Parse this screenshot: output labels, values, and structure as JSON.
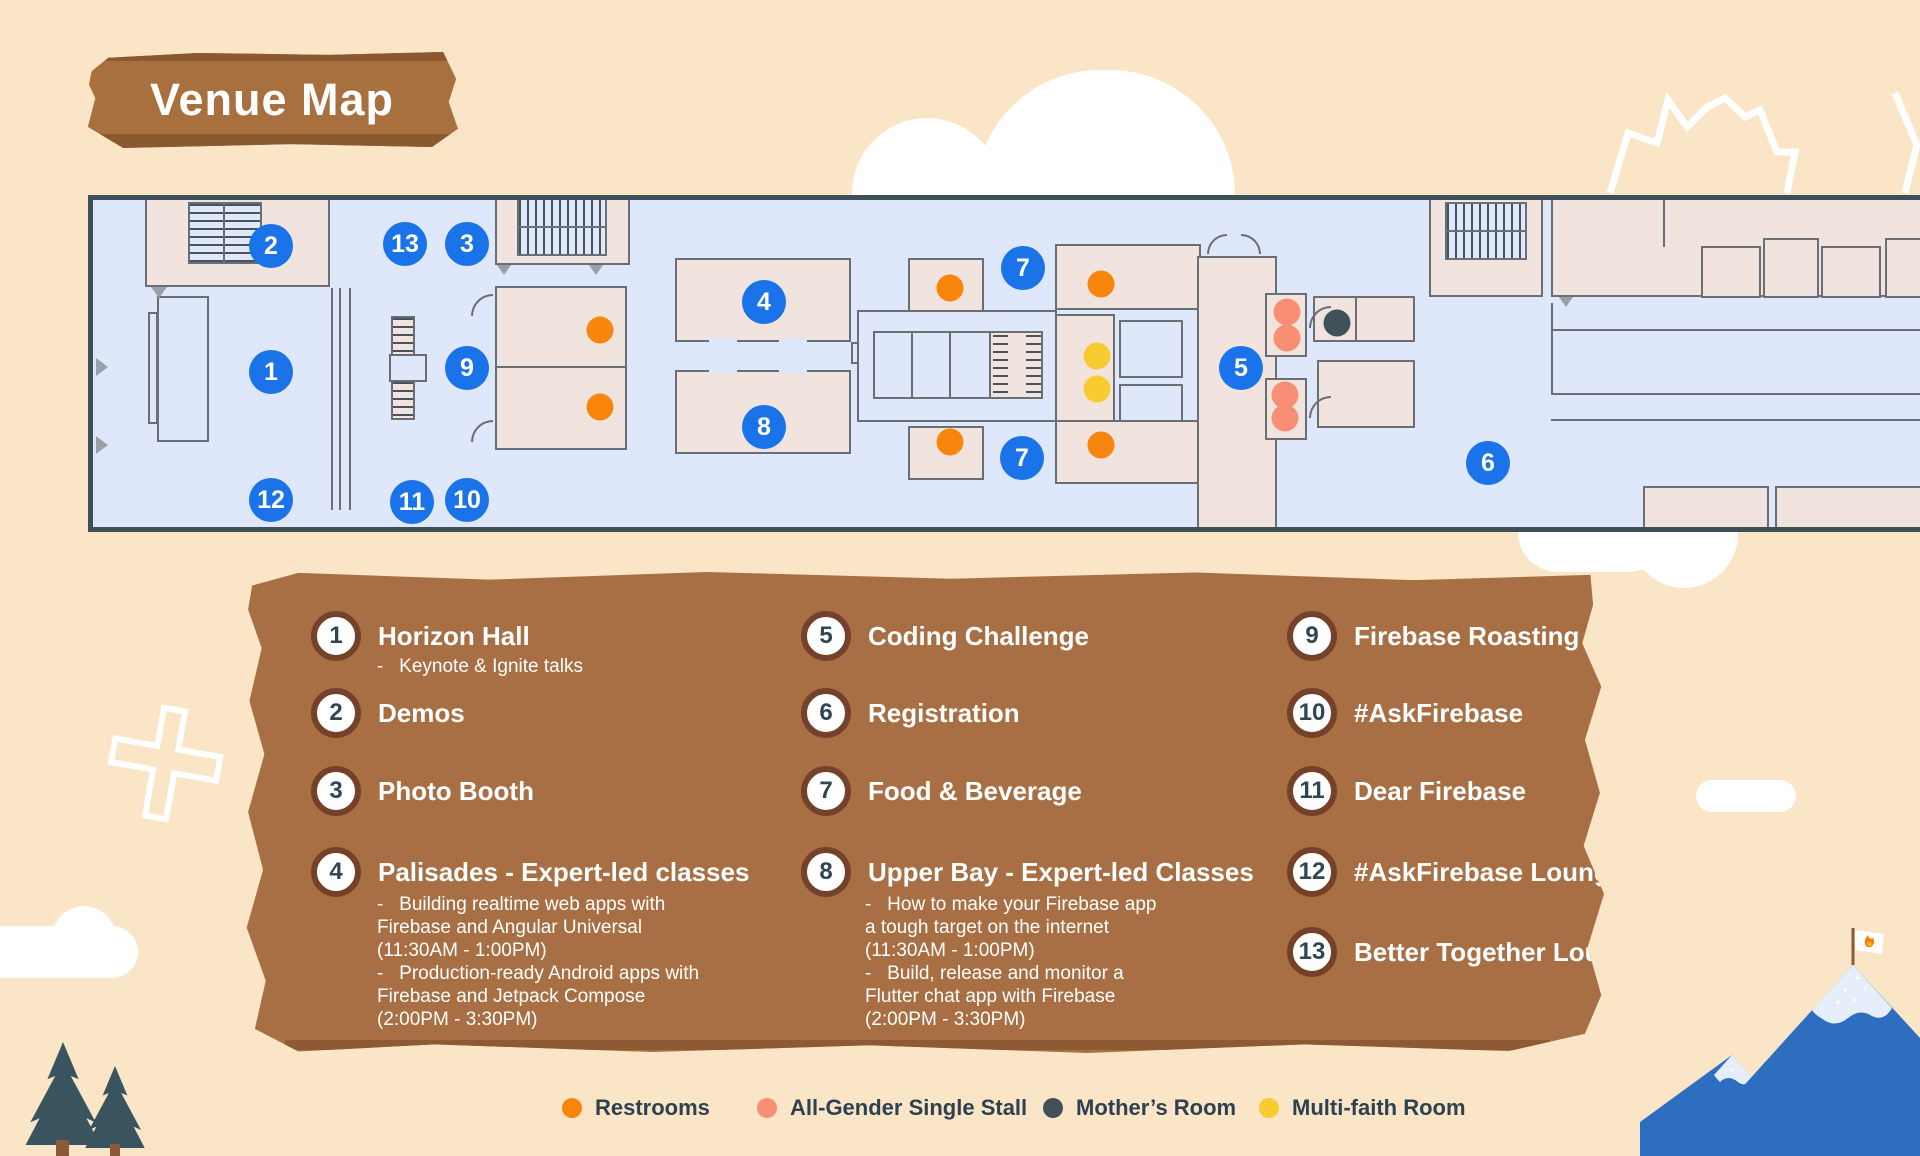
{
  "title": "Venue Map",
  "map": {
    "markers": [
      "2",
      "13",
      "3",
      "4",
      "7",
      "1",
      "9",
      "5",
      "8",
      "7",
      "6",
      "12",
      "11",
      "10"
    ]
  },
  "legend": {
    "items": [
      {
        "number": "1",
        "label": "Horizon Hall",
        "sub": [
          "-   Keynote & Ignite talks"
        ]
      },
      {
        "number": "2",
        "label": "Demos"
      },
      {
        "number": "3",
        "label": "Photo Booth"
      },
      {
        "number": "4",
        "label": "Palisades - Expert-led classes",
        "sub": [
          "-   Building realtime web apps with",
          "Firebase and Angular Universal",
          "(11:30AM - 1:00PM)",
          "-   Production-ready Android apps with",
          "Firebase and Jetpack Compose",
          "(2:00PM - 3:30PM)"
        ]
      },
      {
        "number": "5",
        "label": "Coding Challenge"
      },
      {
        "number": "6",
        "label": "Registration"
      },
      {
        "number": "7",
        "label": "Food & Beverage"
      },
      {
        "number": "8",
        "label": "Upper Bay - Expert-led Classes",
        "sub": [
          "-   How to make your Firebase app",
          "a tough target on the internet",
          "(11:30AM - 1:00PM)",
          "-   Build, release and monitor a",
          "Flutter chat app with Firebase",
          "(2:00PM - 3:30PM)"
        ]
      },
      {
        "number": "9",
        "label": "Firebase Roasting"
      },
      {
        "number": "10",
        "label": "#AskFirebase"
      },
      {
        "number": "11",
        "label": "Dear Firebase"
      },
      {
        "number": "12",
        "label": "#AskFirebase Lounge"
      },
      {
        "number": "13",
        "label": "Better Together Lounge"
      }
    ]
  },
  "key": {
    "items": [
      {
        "label": "Restrooms",
        "color": "#F8860D"
      },
      {
        "label": "All-Gender Single Stall",
        "color": "#F88F74"
      },
      {
        "label": "Mother’s Room",
        "color": "#415159"
      },
      {
        "label": "Multi-faith Room",
        "color": "#F8CC30"
      }
    ]
  },
  "colors": {
    "background": "#FAE5C7",
    "panel": "#A76F43",
    "floor": "#DEE8FA",
    "room": "#F1E4DF",
    "marker_blue": "#1A73E8",
    "restroom": "#F8860D",
    "all_gender": "#F88F74",
    "mothers_room": "#415159",
    "multi_faith": "#F8CC30"
  }
}
